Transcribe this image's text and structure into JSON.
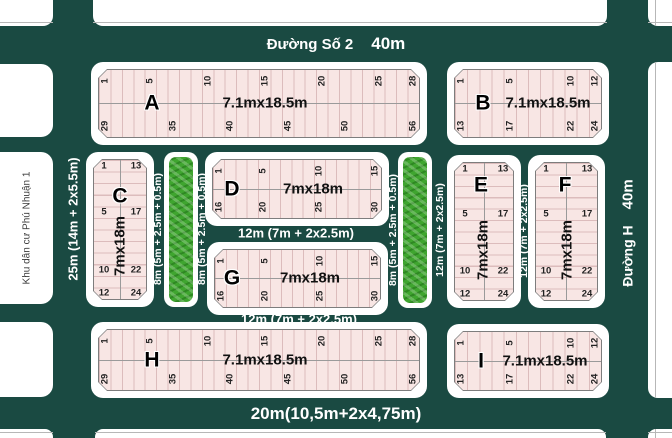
{
  "colors": {
    "street_bg": "#1a4a42",
    "lot_fill": "#f8e6e4",
    "lot_line": "#dcbcbc",
    "lot_border": "#7d7d7d",
    "block_bg": "#ffffff",
    "green": "#3fa52f",
    "street_text": "#ffffff"
  },
  "streets": {
    "top": {
      "name": "Đường Số 2",
      "size": "40m"
    },
    "right": {
      "name": "Đường H",
      "size": "40m"
    },
    "left": {
      "size": "25m (14m + 2x5.5m)"
    },
    "bottom": {
      "size": "20m(10,5m+2x4,75m)"
    },
    "below_d": {
      "size": "12m (7m + 2x2.5m)"
    },
    "below_g": {
      "size": "12m (7m + 2x2.5m)"
    },
    "strip1_left": {
      "size": "8m (5m + 2.5m + 0.5m)"
    },
    "strip1_right": {
      "size": "8m (5m + 2.5m + 0.5m)"
    },
    "strip2_left": {
      "size": "8m (5m + 2.5m + 0.5m)"
    },
    "strip2_right": {
      "size": "12m (7m + 2x2.5m)"
    },
    "between_e_f": {
      "size": "12m (7m + 2x2.5m)"
    }
  },
  "areas": {
    "neighborhood": "Khu dân cư Phú Nhuận 1"
  },
  "blocks": {
    "A": {
      "label": "A",
      "dims": "7.1mx18.5m",
      "orientation": "h",
      "lots_per_row": 28,
      "top_numbers": [
        1,
        5,
        10,
        15,
        20,
        25,
        28
      ],
      "bottom_numbers": [
        29,
        35,
        40,
        45,
        50,
        56
      ]
    },
    "B": {
      "label": "B",
      "dims": "7.1mx18.5m",
      "orientation": "h",
      "lots_per_row": 12,
      "top_numbers": [
        1,
        5,
        10,
        12
      ],
      "bottom_numbers": [
        13,
        17,
        22,
        24
      ]
    },
    "C": {
      "label": "C",
      "dims": "7mx18m",
      "orientation": "v",
      "lots_per_col": 12,
      "left_numbers": [
        1,
        5,
        10,
        12
      ],
      "right_numbers": [
        13,
        17,
        22,
        24
      ]
    },
    "D": {
      "label": "D",
      "dims": "7mx18m",
      "orientation": "h",
      "lots_per_row": 15,
      "top_numbers": [
        1,
        5,
        10,
        15
      ],
      "bottom_numbers": [
        16,
        20,
        25,
        30
      ]
    },
    "E": {
      "label": "E",
      "dims": "7mx18m",
      "orientation": "v",
      "lots_per_col": 12,
      "left_numbers": [
        1,
        5,
        10,
        12
      ],
      "right_numbers": [
        13,
        17,
        22,
        24
      ]
    },
    "F": {
      "label": "F",
      "dims": "7mx18m",
      "orientation": "v",
      "lots_per_col": 12,
      "left_numbers": [
        1,
        5,
        10,
        12
      ],
      "right_numbers": [
        13,
        17,
        22,
        24
      ]
    },
    "G": {
      "label": "G",
      "dims": "7mx18m",
      "orientation": "h",
      "lots_per_row": 15,
      "top_numbers": [
        1,
        5,
        10,
        15
      ],
      "bottom_numbers": [
        16,
        20,
        25,
        30
      ]
    },
    "H": {
      "label": "H",
      "dims": "7.1mx18.5m",
      "orientation": "h",
      "lots_per_row": 28,
      "top_numbers": [
        1,
        5,
        10,
        15,
        20,
        25,
        28
      ],
      "bottom_numbers": [
        29,
        35,
        40,
        45,
        50,
        56
      ]
    },
    "I": {
      "label": "I",
      "dims": "7.1mx18.5m",
      "orientation": "h",
      "lots_per_row": 12,
      "top_numbers": [
        1,
        5,
        10,
        12
      ],
      "bottom_numbers": [
        13,
        17,
        22,
        24
      ]
    }
  }
}
